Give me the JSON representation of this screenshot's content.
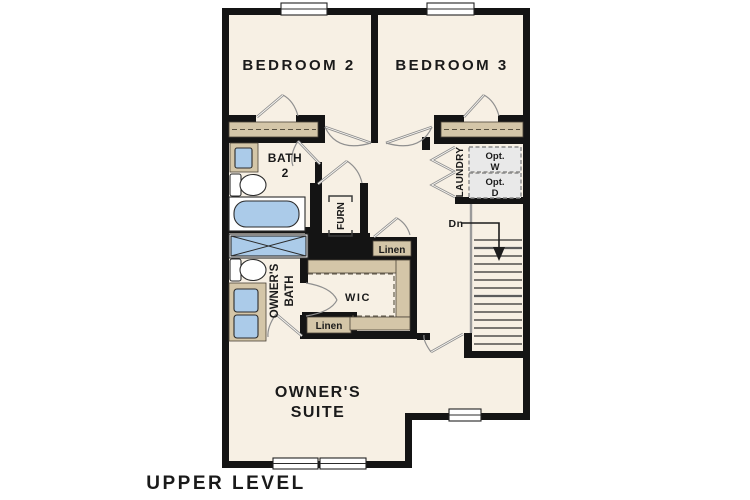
{
  "title": "UPPER LEVEL",
  "colors": {
    "floor": "#f7f0e4",
    "wall": "#141414",
    "shelf": "#d4c6a8",
    "fixture": "#abcbe9",
    "optbox": "#e9e9e9",
    "door": "#8f8f8f",
    "text": "#1a1a1a"
  },
  "rooms": {
    "bedroom2": "BEDROOM 2",
    "bedroom3": "BEDROOM 3",
    "bath2_line1": "BATH",
    "bath2_line2": "2",
    "laundry": "LAUNDRY",
    "opt_w_line1": "Opt.",
    "opt_w_line2": "W",
    "opt_d_line1": "Opt.",
    "opt_d_line2": "D",
    "furnace": "FURN",
    "linen_upper": "Linen",
    "linen_lower": "Linen",
    "wic": "WIC",
    "owners_bath_line1": "OWNER'S",
    "owners_bath_line2": "BATH",
    "owners_suite_line1": "OWNER'S",
    "owners_suite_line2": "SUITE",
    "stairs_down": "Dn"
  }
}
